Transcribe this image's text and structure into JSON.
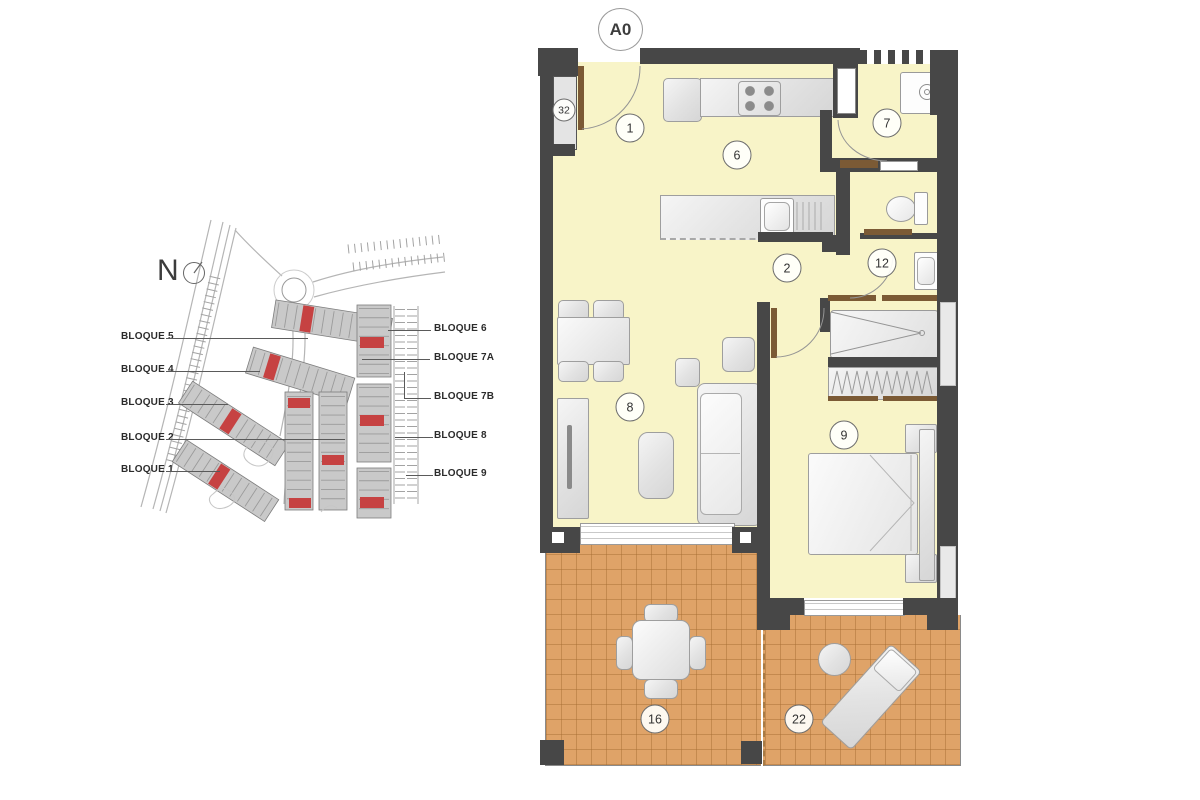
{
  "sheet": {
    "label": "A0"
  },
  "site_plan": {
    "north_label": "N",
    "left_blocks": [
      {
        "label": "BLOQUE 5"
      },
      {
        "label": "BLOQUE 4"
      },
      {
        "label": "BLOQUE 3"
      },
      {
        "label": "BLOQUE 2"
      },
      {
        "label": "BLOQUE 1"
      }
    ],
    "right_blocks": [
      {
        "label": "BLOQUE 6"
      },
      {
        "label": "BLOQUE 7A"
      },
      {
        "label": "BLOQUE 7B"
      },
      {
        "label": "BLOQUE 8"
      },
      {
        "label": "BLOQUE 9"
      }
    ],
    "highlight_color": "#c64242"
  },
  "floor_plan": {
    "rooms": [
      {
        "number": "1"
      },
      {
        "number": "2"
      },
      {
        "number": "6"
      },
      {
        "number": "7"
      },
      {
        "number": "8"
      },
      {
        "number": "9"
      },
      {
        "number": "12"
      },
      {
        "number": "16"
      },
      {
        "number": "22"
      },
      {
        "number": "32"
      }
    ],
    "colors": {
      "wall": "#474747",
      "floor": "#f8f4c8",
      "terrace": "#dfa368",
      "door_wood": "#7b5a35"
    }
  }
}
